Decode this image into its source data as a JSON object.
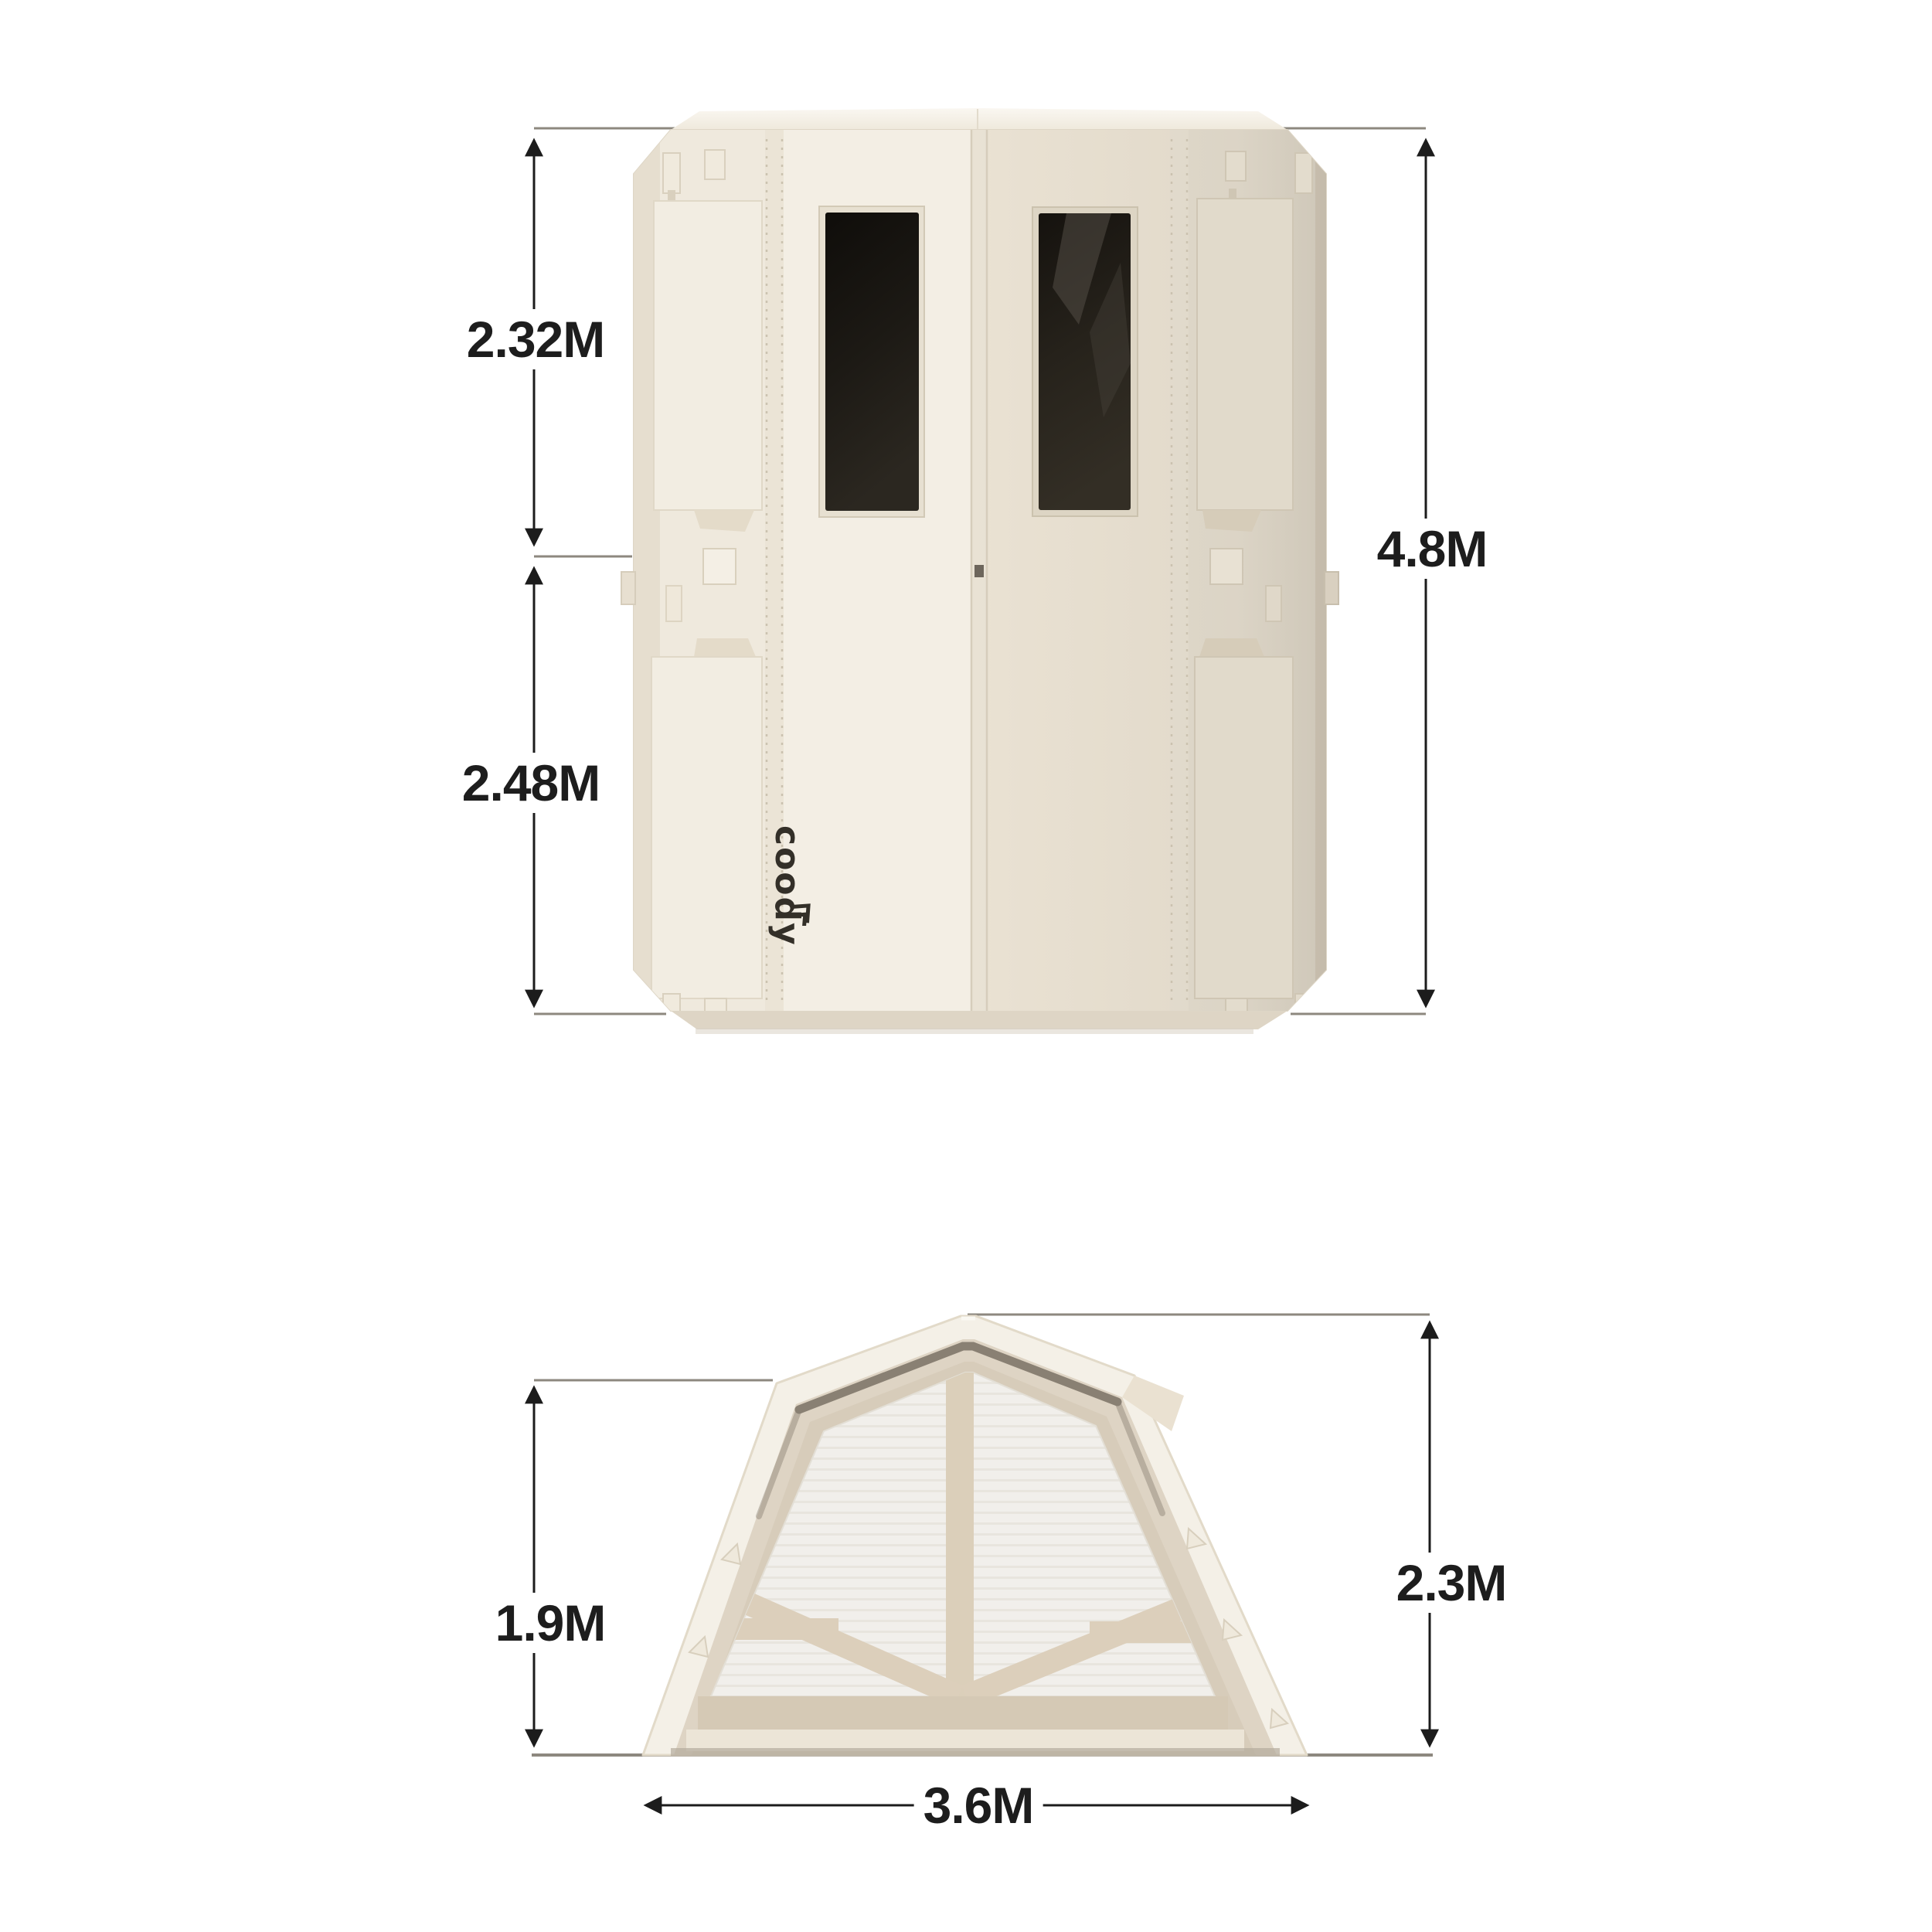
{
  "brand": {
    "logo_text": "coody"
  },
  "figures": {
    "folded_unit": {
      "dimensions": {
        "upper_height": "2.32M",
        "lower_height": "2.48M",
        "total_height": "4.8M"
      }
    },
    "tent": {
      "dimensions": {
        "wall_height": "1.9M",
        "peak_height": "2.3M",
        "width": "3.6M"
      }
    }
  },
  "colors": {
    "background": "#ffffff",
    "shell_cream": "#efe9dd",
    "panel_light": "#f3eee4",
    "panel_dark": "#eae2d3",
    "rail_right_shade": "#ddd5c7",
    "window_dark": "#17130e",
    "frame_beige": "#d7ccba",
    "mesh_light": "#f1efeb",
    "strap_beige": "#dbcfba",
    "dimension_line": "#1c1c1c",
    "guide_line": "#8d887f",
    "logo_ink": "#332f28"
  }
}
